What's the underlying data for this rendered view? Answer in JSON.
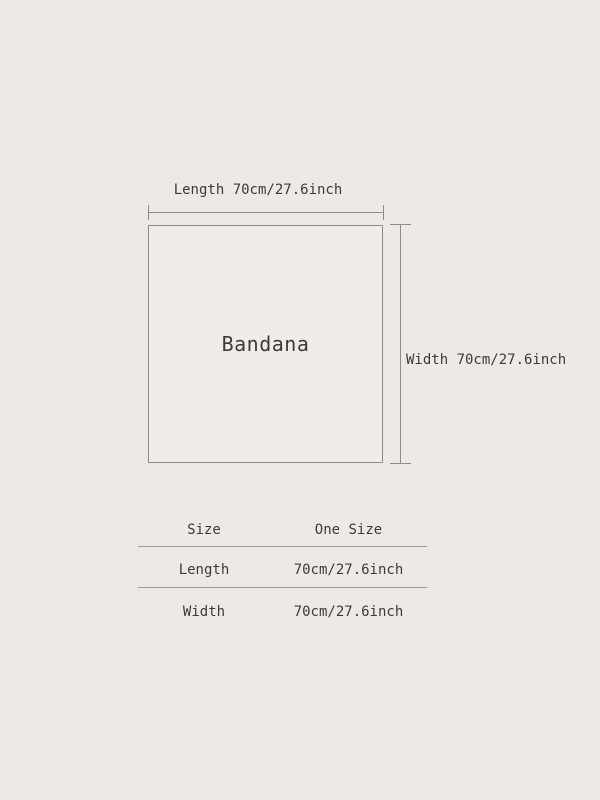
{
  "diagram": {
    "product_name": "Bandana",
    "length_label": "Length 70cm/27.6inch",
    "width_label": "Width 70cm/27.6inch"
  },
  "size_table": {
    "header": {
      "col1": "Size",
      "col2": "One Size"
    },
    "rows": [
      {
        "label": "Length",
        "value": "70cm/27.6inch"
      },
      {
        "label": "Width",
        "value": "70cm/27.6inch"
      }
    ]
  },
  "colors": {
    "background": "#EDEAE5",
    "square_fill": "#F0EDE8",
    "dimension_line": "#8F8D8A",
    "table_line": "#9E9C98",
    "text": "#3C3B38"
  }
}
